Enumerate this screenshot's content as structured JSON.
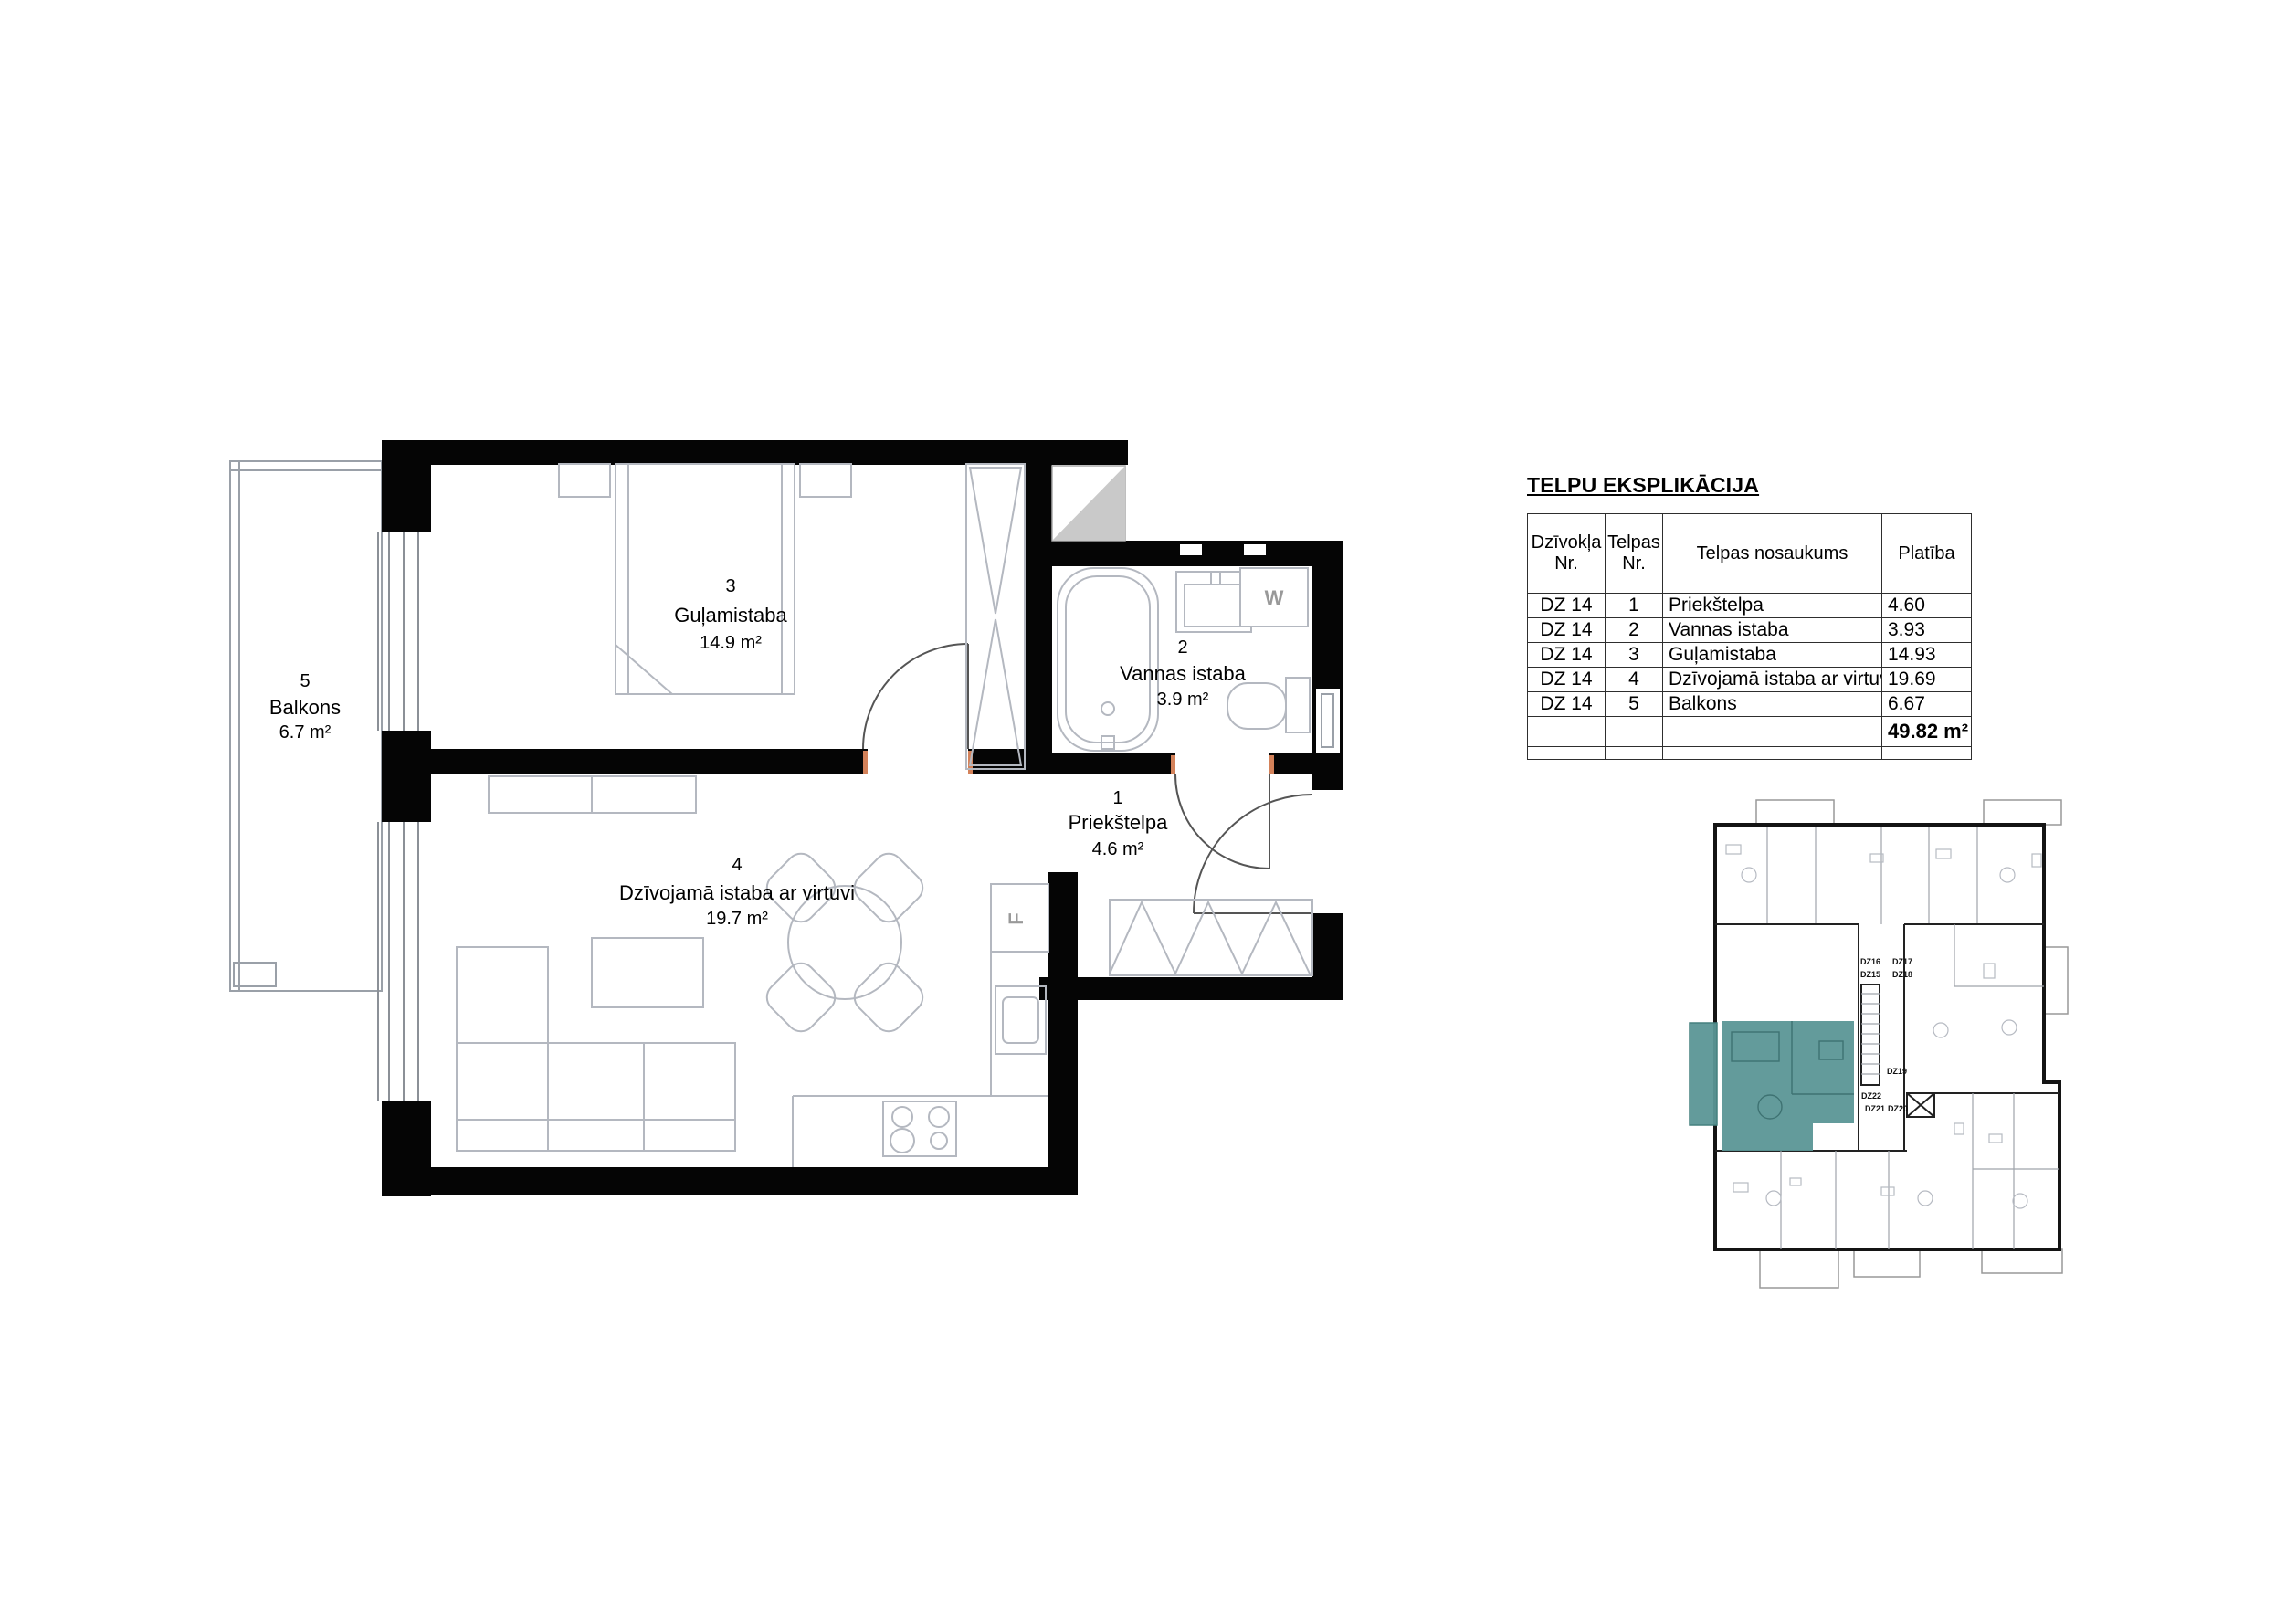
{
  "explication": {
    "title": "TELPU EKSPLIKĀCIJA",
    "headers": {
      "apartment_nr": "Dzīvokļa Nr.",
      "room_nr": "Telpas Nr.",
      "room_name": "Telpas nosaukums",
      "area": "Platība"
    },
    "rows": [
      {
        "apartment": "DZ 14",
        "room": "1",
        "name": "Priekštelpa",
        "area": "4.60"
      },
      {
        "apartment": "DZ 14",
        "room": "2",
        "name": "Vannas istaba",
        "area": "3.93"
      },
      {
        "apartment": "DZ 14",
        "room": "3",
        "name": "Guļamistaba",
        "area": "14.93"
      },
      {
        "apartment": "DZ 14",
        "room": "4",
        "name": "Dzīvojamā istaba ar virtuvi",
        "area": "19.69"
      },
      {
        "apartment": "DZ 14",
        "room": "5",
        "name": "Balkons",
        "area": "6.67"
      }
    ],
    "total_area": "49.82 m²"
  },
  "floorplan": {
    "rooms": [
      {
        "number": "1",
        "name": "Priekštelpa",
        "area": "4.6 m²"
      },
      {
        "number": "2",
        "name": "Vannas istaba",
        "area": "3.9 m²"
      },
      {
        "number": "3",
        "name": "Guļamistaba",
        "area": "14.9 m²"
      },
      {
        "number": "4",
        "name": "Dzīvojamā istaba ar virtuvi",
        "area": "19.7 m²"
      },
      {
        "number": "5",
        "name": "Balkons",
        "area": "6.7 m²"
      }
    ],
    "appliances": {
      "washing_machine": "W",
      "fridge": "F"
    }
  },
  "overview_plan": {
    "highlight_color": "#5b9696",
    "apartment_codes": [
      "DZ16",
      "DZ17",
      "DZ15",
      "DZ18",
      "DZ19",
      "DZ22",
      "DZ21",
      "DZ20"
    ]
  }
}
